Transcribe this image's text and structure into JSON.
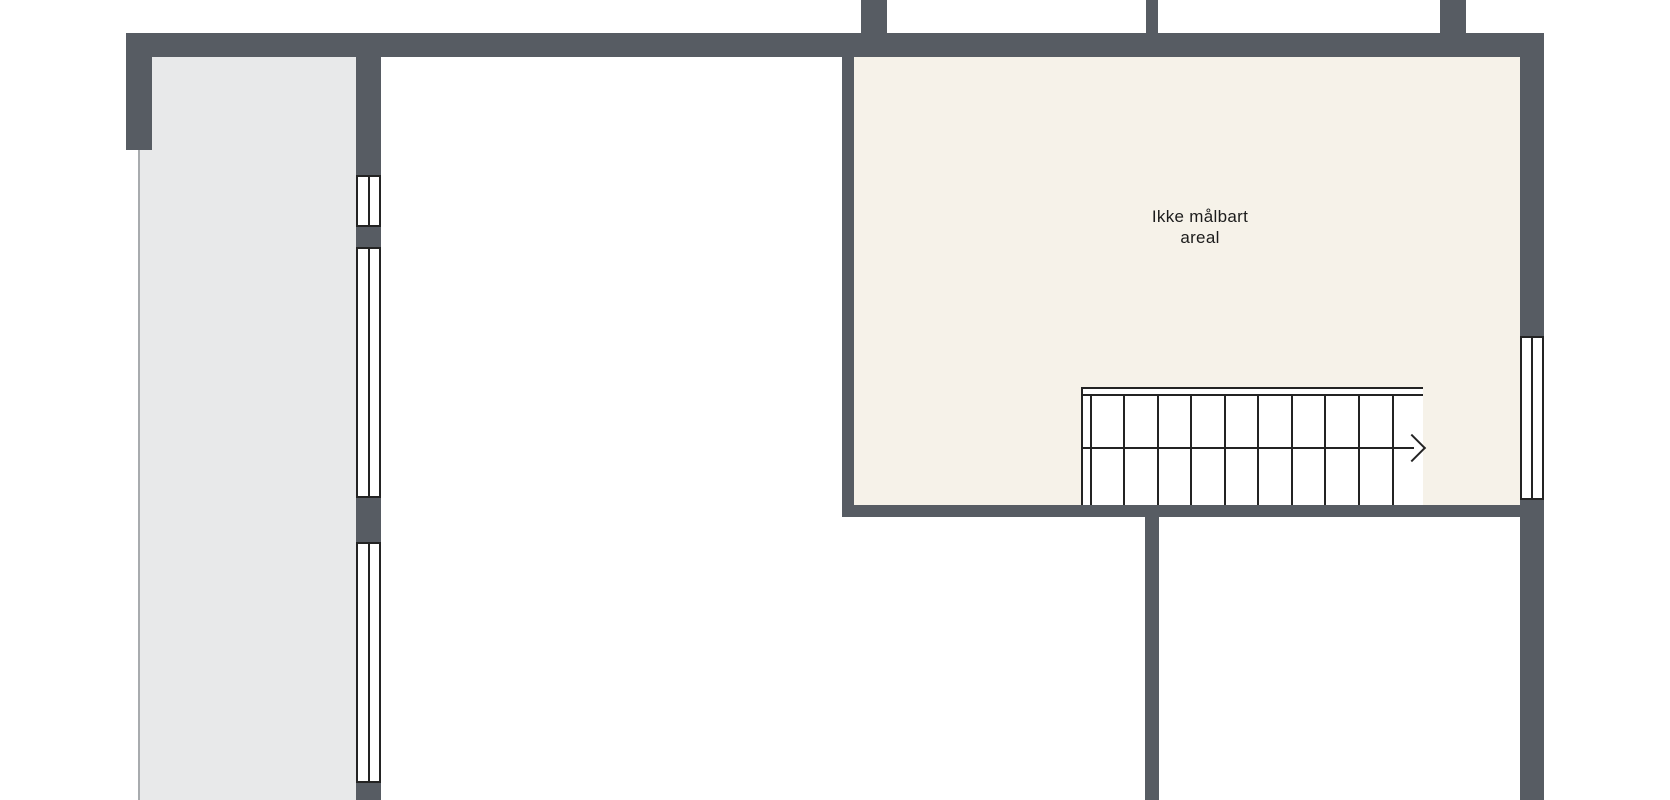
{
  "label": {
    "line1": "Ikke målbart",
    "line2": "areal",
    "full_text": "Ikke målbart areal"
  },
  "colors": {
    "wall": "#575c63",
    "room_gray": "#e8e9ea",
    "room_cream": "#f6f2e9",
    "line": "#232323",
    "thin_line": "#a8abae",
    "background": "#ffffff",
    "text": "#1c1c1c"
  },
  "floorplan": {
    "canvas": {
      "width": 1670,
      "height": 800
    },
    "rooms": [
      {
        "name": "side-room-gray",
        "x": 139,
        "y": 57,
        "w": 217,
        "h": 743,
        "fill": "room_gray"
      },
      {
        "name": "unmeasurable-area-room",
        "x": 854,
        "y": 57,
        "w": 666,
        "h": 450,
        "fill": "room_cream"
      }
    ],
    "walls": [
      {
        "name": "top-exterior-wall",
        "x": 126,
        "y": 33,
        "w": 1418,
        "h": 24
      },
      {
        "name": "left-exterior-wall-stub",
        "x": 126,
        "y": 33,
        "w": 26,
        "h": 117
      },
      {
        "name": "upper-party-wall-stub-1",
        "x": 861,
        "y": 0,
        "w": 26,
        "h": 33
      },
      {
        "name": "upper-party-wall-stub-2",
        "x": 1146,
        "y": 0,
        "w": 12,
        "h": 33
      },
      {
        "name": "upper-party-wall-stub-3",
        "x": 1440,
        "y": 0,
        "w": 26,
        "h": 33
      },
      {
        "name": "gray-room-east-wall-seg-1",
        "x": 356,
        "y": 57,
        "w": 25,
        "h": 118
      },
      {
        "name": "gray-room-east-wall-seg-2",
        "x": 356,
        "y": 227,
        "w": 25,
        "h": 20
      },
      {
        "name": "gray-room-east-wall-seg-3",
        "x": 356,
        "y": 498,
        "w": 25,
        "h": 44
      },
      {
        "name": "gray-room-east-wall-seg-4",
        "x": 356,
        "y": 783,
        "w": 25,
        "h": 17
      },
      {
        "name": "cream-room-west-wall",
        "x": 842,
        "y": 57,
        "w": 12,
        "h": 460
      },
      {
        "name": "cream-room-south-wall",
        "x": 842,
        "y": 505,
        "w": 702,
        "h": 12
      },
      {
        "name": "right-exterior-wall-seg-1",
        "x": 1520,
        "y": 33,
        "w": 24,
        "h": 303
      },
      {
        "name": "right-exterior-wall-seg-2",
        "x": 1520,
        "y": 500,
        "w": 24,
        "h": 300
      },
      {
        "name": "lower-interior-wall",
        "x": 1145,
        "y": 517,
        "w": 14,
        "h": 283
      }
    ],
    "windows": [
      {
        "name": "window-gray-room-1",
        "x": 356,
        "y": 175,
        "w": 25,
        "h": 52
      },
      {
        "name": "window-gray-room-2",
        "x": 356,
        "y": 247,
        "w": 25,
        "h": 251
      },
      {
        "name": "window-gray-room-3",
        "x": 356,
        "y": 542,
        "w": 25,
        "h": 241
      },
      {
        "name": "window-right-wall",
        "x": 1520,
        "y": 336,
        "w": 24,
        "h": 164
      }
    ],
    "thin_lines": [
      {
        "name": "gray-room-west-boundary-line",
        "x": 138,
        "y": 150,
        "w": 2,
        "h": 650
      }
    ],
    "stairs": {
      "name": "staircase",
      "x": 1081,
      "y": 387,
      "w": 342,
      "h": 118,
      "top_bar_h": 9,
      "tread_offsets": [
        7,
        40,
        74,
        107,
        141,
        174,
        208,
        241,
        275,
        309
      ],
      "mid_line_y": 60,
      "mid_line_w": 331,
      "arrow": {
        "direction": "right",
        "chevron_left": 319,
        "chevron_top": 51,
        "chevron_size": 20
      }
    }
  }
}
